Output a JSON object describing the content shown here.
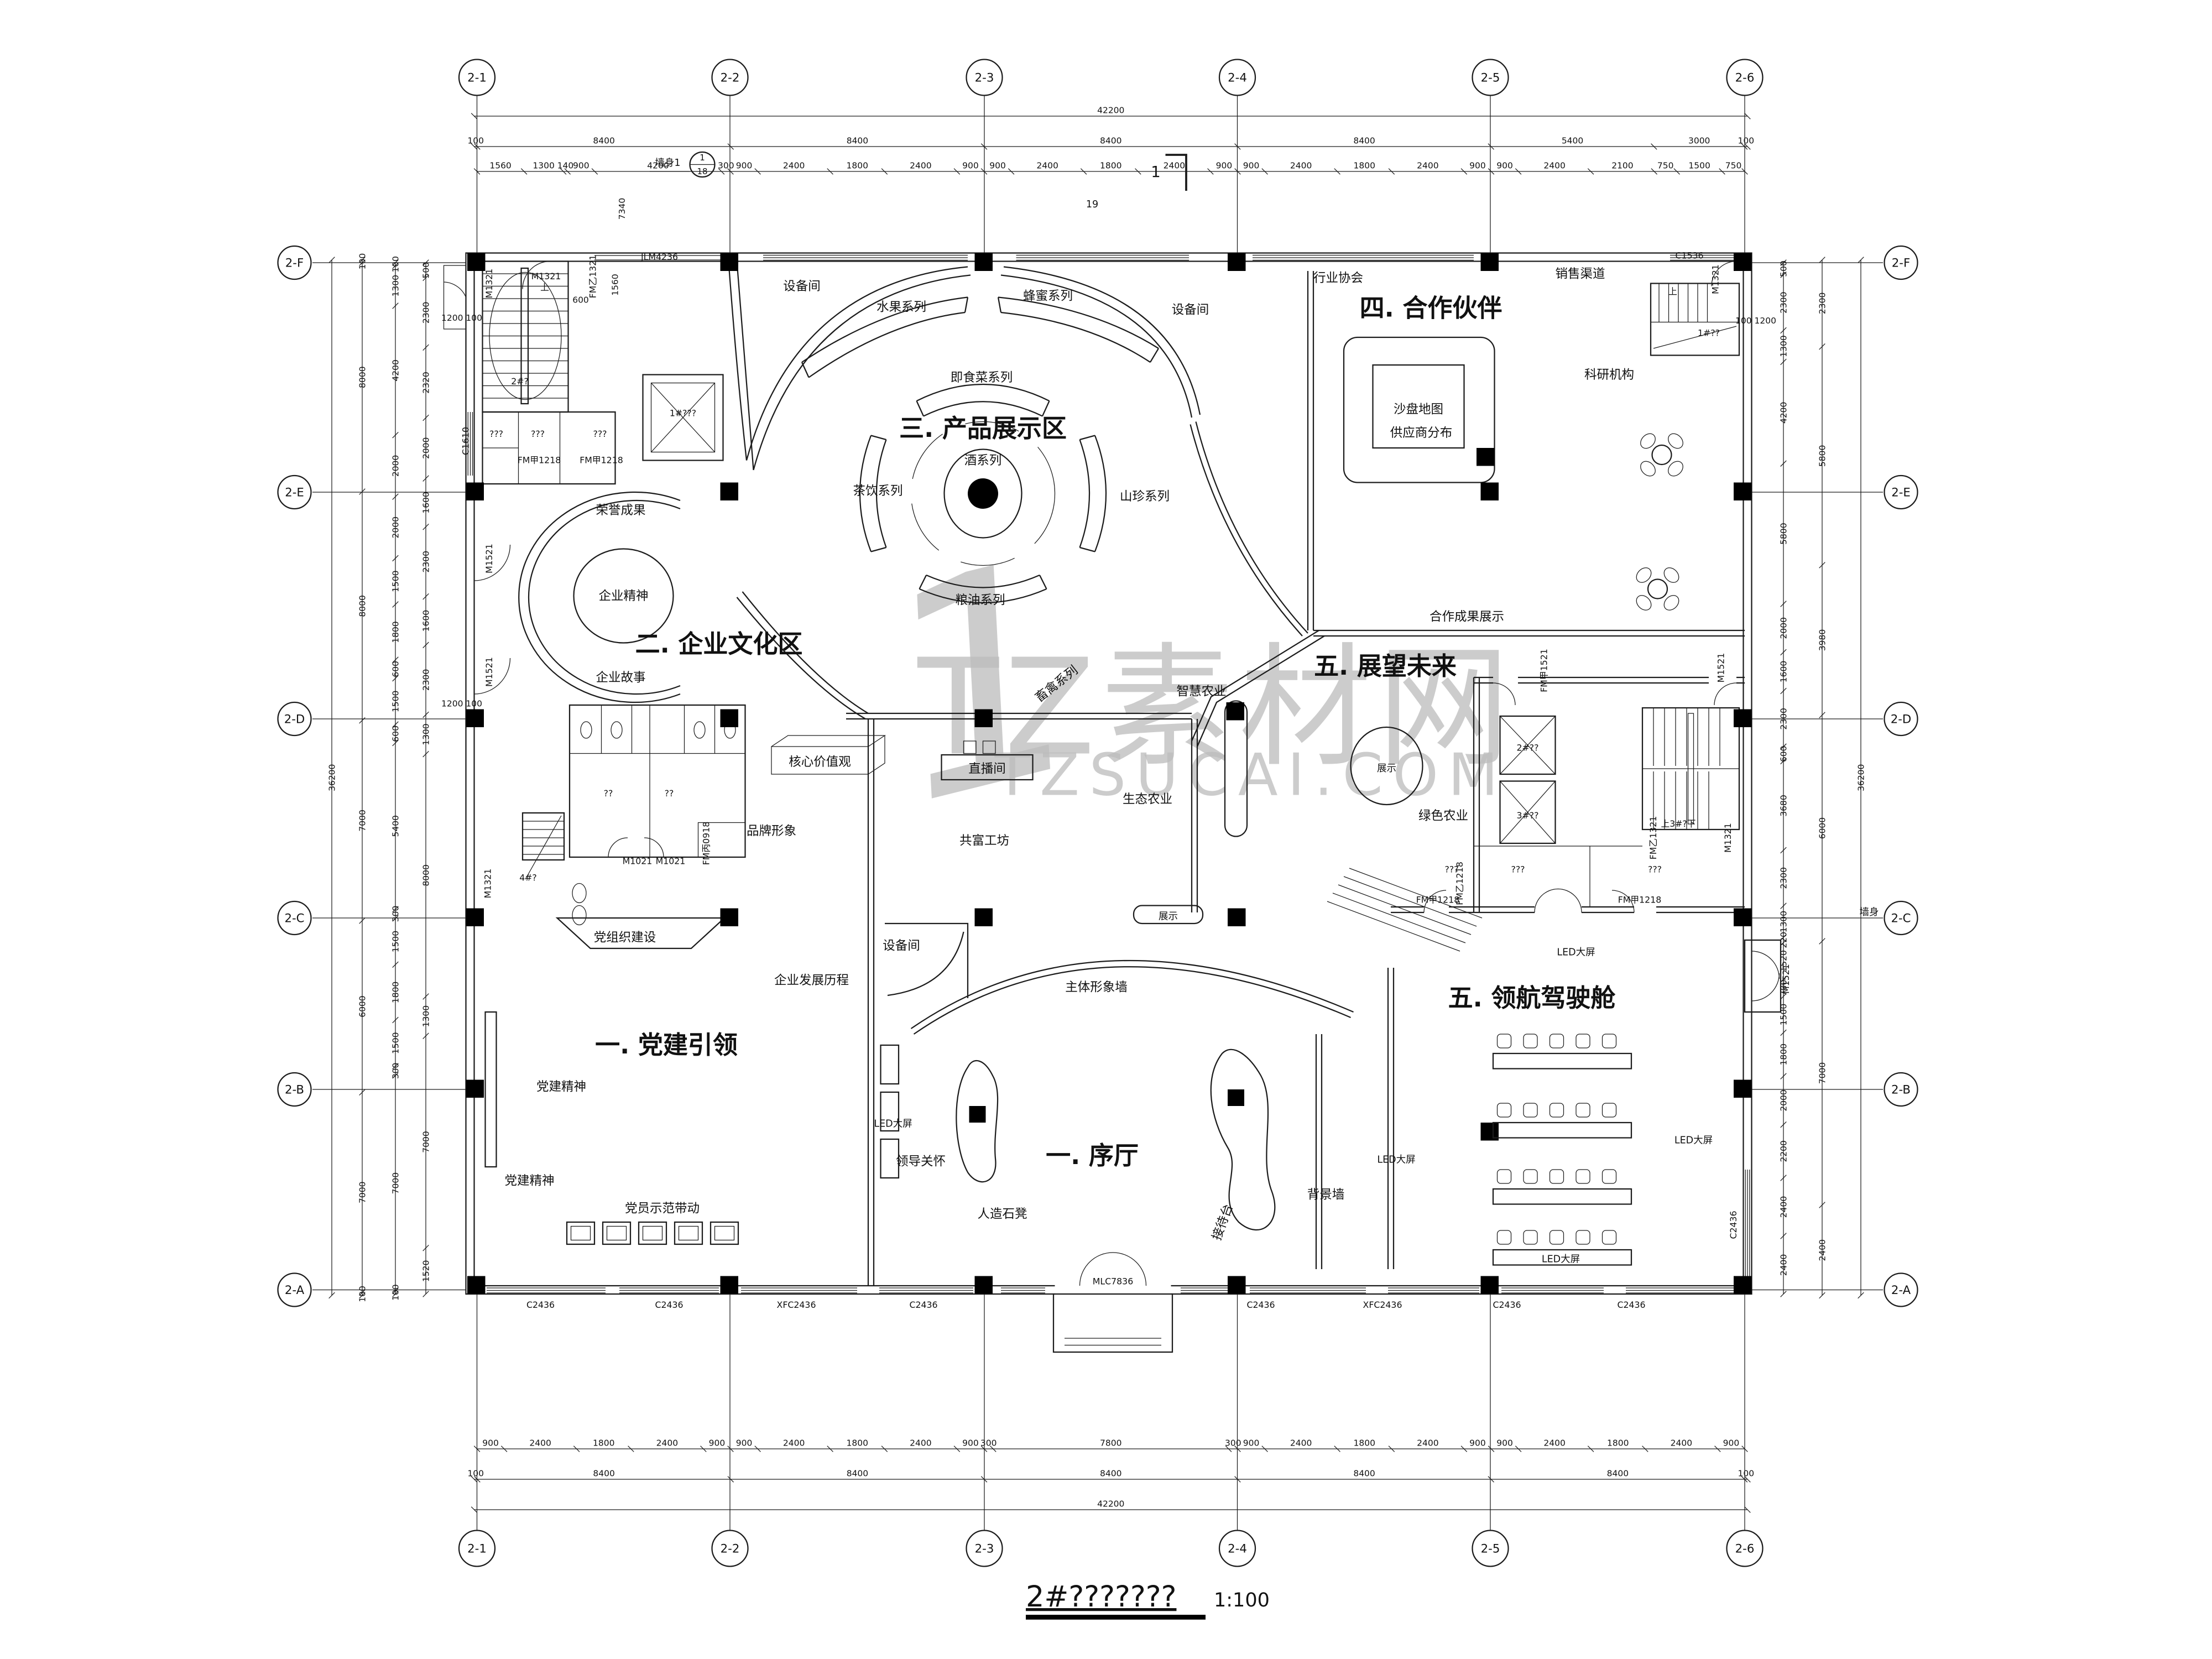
{
  "sheet": {
    "title": "2#???????",
    "scale": "1:100",
    "page_note": "19",
    "section_no": "1",
    "wall_detail_label": "墙身1",
    "wall_detail_no": "1",
    "wall_detail_sheet": "18",
    "wall_note_right": "墙身"
  },
  "watermark": {
    "logo_glyph": "1",
    "brand_text": "TZ素材网",
    "url_text": "TZSUCAI.COM",
    "color": "#bcbcbc"
  },
  "grid": {
    "top": [
      "2-1",
      "2-2",
      "2-3",
      "2-4",
      "2-5",
      "2-6"
    ],
    "bottom": [
      "2-1",
      "2-2",
      "2-3",
      "2-4",
      "2-5",
      "2-6"
    ],
    "left": [
      "2-F",
      "2-E",
      "2-D",
      "2-C",
      "2-B",
      "2-A"
    ],
    "right": [
      "2-F",
      "2-E",
      "2-D",
      "2-C",
      "2-B",
      "2-A"
    ]
  },
  "zones": {
    "z1": "一. 党建引领",
    "lobby": "一. 序厅",
    "z2": "二. 企业文化区",
    "z3": "三. 产品展示区",
    "z4": "四. 合作伙伴",
    "z5a": "五. 展望未来",
    "z5b": "五. 领航驾驶舱"
  },
  "labels": {
    "eq_a": "设备间",
    "eq_b": "设备间",
    "eq_c": "设备间",
    "fruit": "水果系列",
    "honey": "蜂蜜系列",
    "instant": "即食菜系列",
    "wine": "酒系列",
    "tea": "茶饮系列",
    "mountain": "山珍系列",
    "grain": "粮油系列",
    "livestock": "畜禽系列",
    "assoc": "行业协会",
    "sales": "销售渠道",
    "research": "科研机构",
    "sand_map": "沙盘地图",
    "sand_sub": "供应商分布",
    "coop_res": "合作成果展示",
    "honor": "荣誉成果",
    "spirit": "企业精神",
    "story": "企业故事",
    "smart": "智慧农业",
    "eco": "生态农业",
    "green": "绿色农业",
    "core_vals": "核心价值观",
    "live": "直播间",
    "brand": "品牌形象",
    "workshop": "共富工坊",
    "disp": "展示",
    "porg": "党组织建设",
    "hist": "企业发展历程",
    "pspirit": "党建精神",
    "model": "党员示范带动",
    "mwall": "主体形象墙",
    "led": "LED大屏",
    "care": "领导关怀",
    "stone": "人造石凳",
    "recp": "接待台",
    "bgw": "背景墙"
  },
  "tags": {
    "m1321": "M1321",
    "m1521": "M1521",
    "m1021": "M1021",
    "jlm4236": "JLM4236",
    "fmy1321": "FM乙1321",
    "fmj1218": "FM甲1218",
    "fmy1218": "FM乙1218",
    "fmb0918": "FM丙0918",
    "fmj1521": "FM甲1521",
    "c1536": "C1536",
    "c1610": "C1610",
    "c2436": "C2436",
    "xfc2436": "XFC2436",
    "mlc7836": "MLC7836",
    "stair1": "1#??",
    "stair2": "2#?",
    "stair3": "上3#?下",
    "stair4": "4#?",
    "elev1": "1#???",
    "elev2": "2#??",
    "elev3": "3#??",
    "up": "上",
    "q3": "???",
    "q2": "??"
  },
  "dims": {
    "top_row1": [
      42200
    ],
    "top_row2": [
      100,
      8400,
      8400,
      8400,
      8400,
      5400,
      3000,
      100
    ],
    "top_row3": [
      1560,
      1300,
      140,
      900,
      4200,
      300,
      900,
      2400,
      1800,
      2400,
      900,
      900,
      2400,
      1800,
      2400,
      900,
      900,
      2400,
      1800,
      2400,
      900,
      900,
      2400,
      2100,
      750,
      1500,
      750
    ],
    "bottom_row3": [
      900,
      2400,
      1800,
      2400,
      900,
      900,
      2400,
      1800,
      2400,
      900,
      300,
      7800,
      300,
      900,
      2400,
      1800,
      2400,
      900,
      900,
      2400,
      1800,
      2400,
      900
    ],
    "bottom_row2": [
      100,
      8400,
      8400,
      8400,
      8400,
      8400,
      100
    ],
    "bottom_row1": [
      42200
    ],
    "left_row1": [
      36200
    ],
    "left_row2": [
      100,
      8000,
      8000,
      7000,
      6000,
      7000,
      100
    ],
    "left_row3": [
      100,
      1300,
      4200,
      2000,
      2000,
      1500,
      1800,
      600,
      1500,
      600,
      5400,
      300,
      1500,
      1800,
      1500,
      300,
      7000,
      100
    ],
    "left_row4": [
      500,
      2300,
      2320,
      2000,
      1600,
      2300,
      1600,
      2300,
      1300,
      8000,
      1300,
      7000,
      1520
    ],
    "right_row3": [
      500,
      2300,
      1300,
      4200,
      5800,
      2000,
      1600,
      2300,
      600,
      3680,
      2300,
      1300,
      220,
      1520,
      700,
      1500,
      1800,
      2000,
      2200,
      2400,
      2400
    ],
    "right_row2": [
      2300,
      5800,
      3980,
      6000,
      7000,
      2400
    ],
    "right_row1": [
      36200
    ]
  },
  "dim_texts": {
    "a7340": "7340",
    "a1560": "1560",
    "a600": "600",
    "a1200a": "1200 100",
    "a1200b": "1200 100",
    "a100_1200": "100 1200"
  },
  "cockpit": {
    "rows": 4,
    "seats_per_row": 5
  }
}
